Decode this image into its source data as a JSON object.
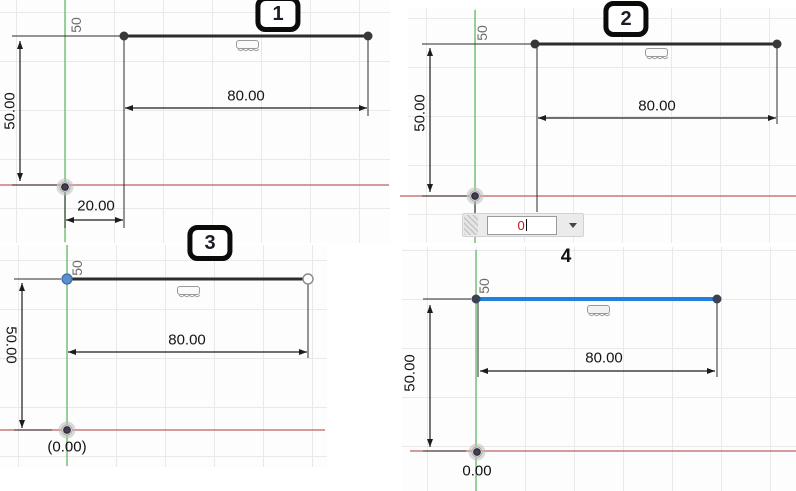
{
  "figure": "CAD sketch dimensioning sequence, four steps",
  "colors": {
    "selected_line": "#2080e0",
    "sketch_line": "#2d2d2d",
    "axis_y_green": "#6fbf6f",
    "axis_x_red": "#c25e5e",
    "dim_input_text": "#cc1111",
    "grid_line": "#e9e9e9"
  },
  "panels": [
    {
      "step": "1",
      "axis_label": "50",
      "vertical_dim": "50.00",
      "length_dim": "80.00",
      "offset_dim": "20.00"
    },
    {
      "step": "2",
      "axis_label": "50",
      "vertical_dim": "50.00",
      "length_dim": "80.00",
      "dim_input": {
        "value": "0"
      }
    },
    {
      "step": "3",
      "axis_label": "50",
      "vertical_dim": "50.00",
      "length_dim": "80.00",
      "origin_coordinate": "(0.00)"
    },
    {
      "step": "4",
      "axis_label": "50",
      "vertical_dim": "50.00",
      "length_dim": "80.00",
      "origin_coordinate": "0.00"
    }
  ]
}
